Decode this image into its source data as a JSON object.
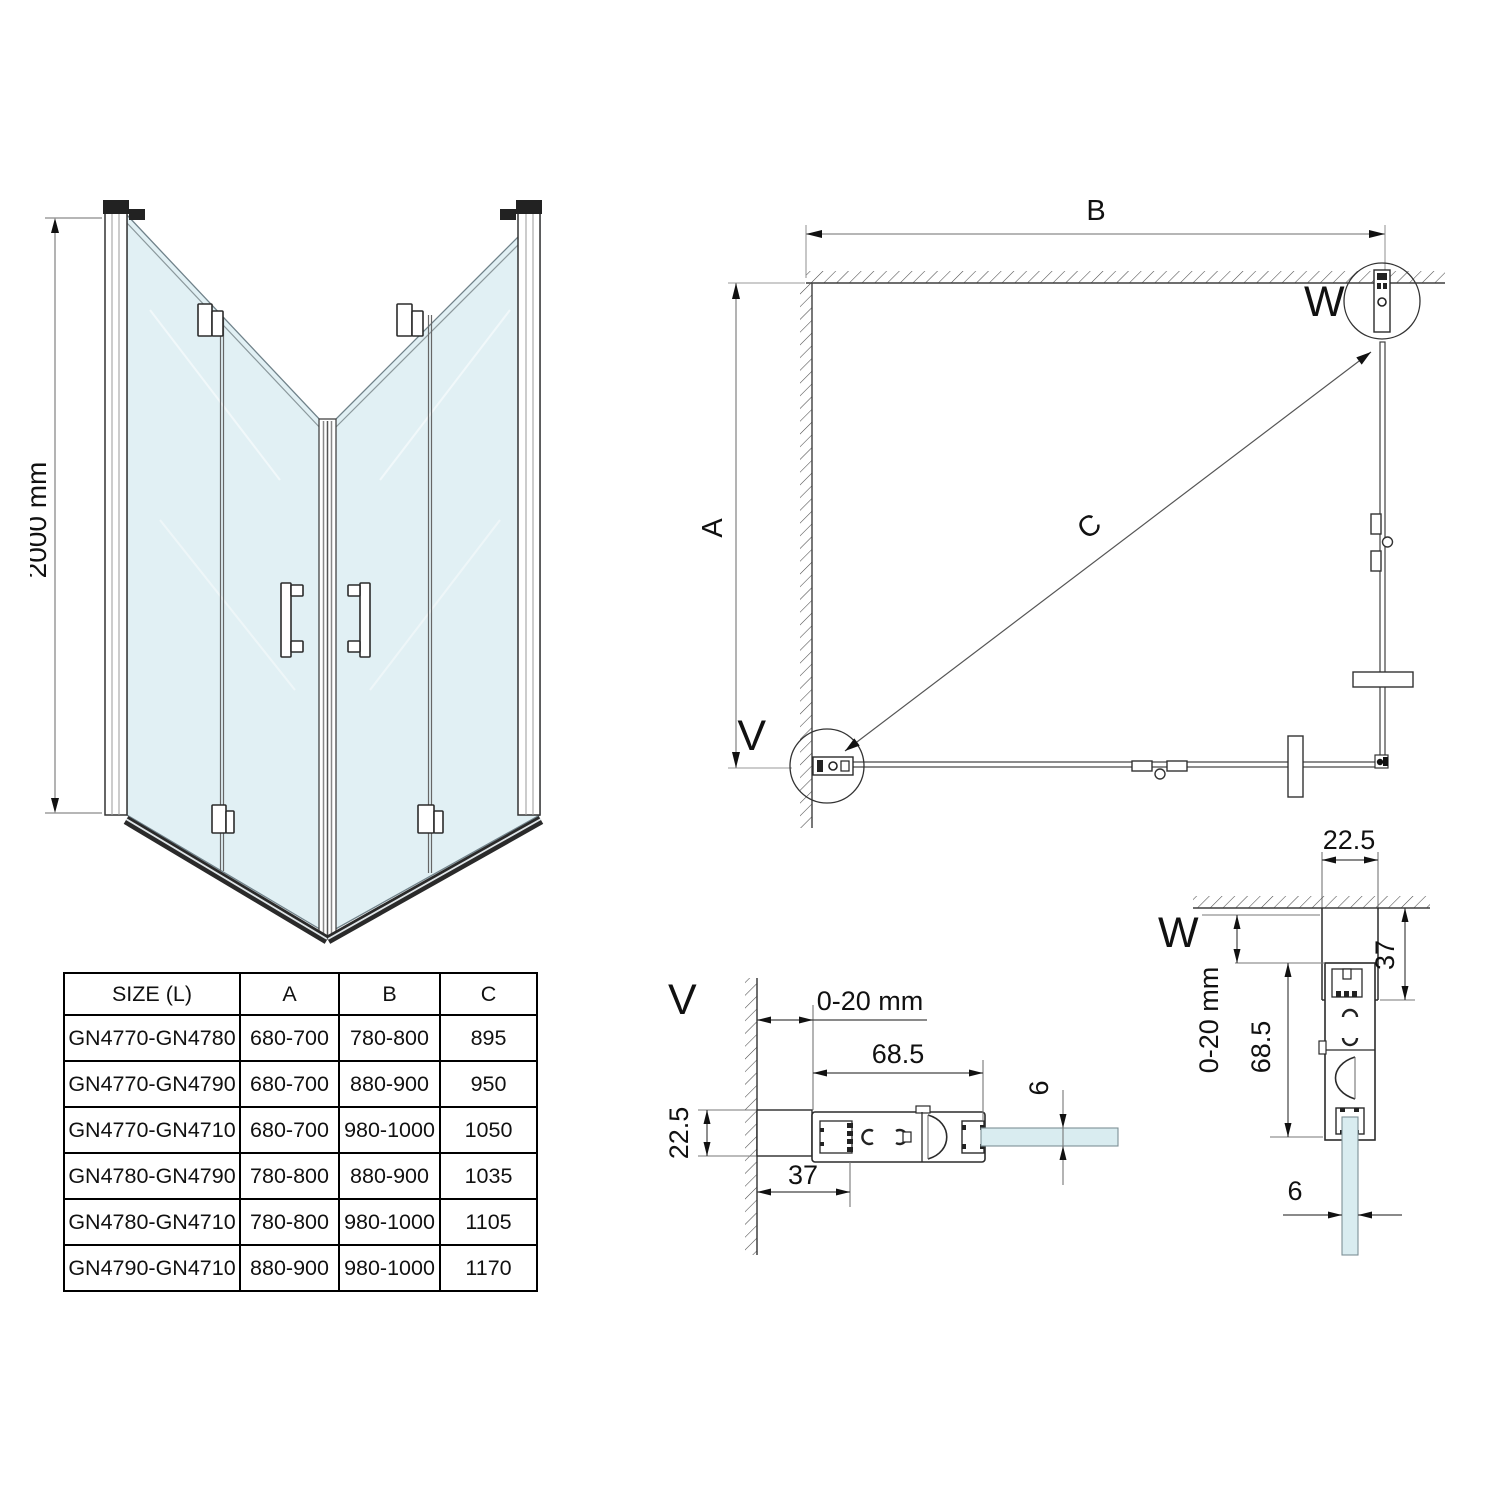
{
  "front_view": {
    "height_dim": "2000 mm"
  },
  "plan_view": {
    "width_dim": "B",
    "depth_dim": "A",
    "diagonal_dim": "C",
    "detail_v_label": "V",
    "detail_w_label": "W"
  },
  "detail_v": {
    "label": "V",
    "gap_dim": "0-20 mm",
    "profile_width_dim": "68.5",
    "profile_depth_dim": "22.5",
    "wall_profile_dim": "37",
    "glass_thickness_dim": "6"
  },
  "detail_w": {
    "label": "W",
    "profile_width_dim": "22.5",
    "wall_profile_dim": "37",
    "gap_dim": "0-20 mm",
    "profile_height_dim": "68.5",
    "glass_thickness_dim": "6"
  },
  "size_table": {
    "headers": [
      "SIZE (L)",
      "A",
      "B",
      "C"
    ],
    "rows": [
      [
        "GN4770-GN4780",
        "680-700",
        "780-800",
        "895"
      ],
      [
        "GN4770-GN4790",
        "680-700",
        "880-900",
        "950"
      ],
      [
        "GN4770-GN4710",
        "680-700",
        "980-1000",
        "1050"
      ],
      [
        "GN4780-GN4790",
        "780-800",
        "880-900",
        "1035"
      ],
      [
        "GN4780-GN4710",
        "780-800",
        "980-1000",
        "1105"
      ],
      [
        "GN4790-GN4710",
        "880-900",
        "980-1000",
        "1170"
      ]
    ]
  },
  "colors": {
    "glass": "#e1f0f4",
    "line": "#2b2b2b",
    "dim_line": "#8a8a8a"
  }
}
